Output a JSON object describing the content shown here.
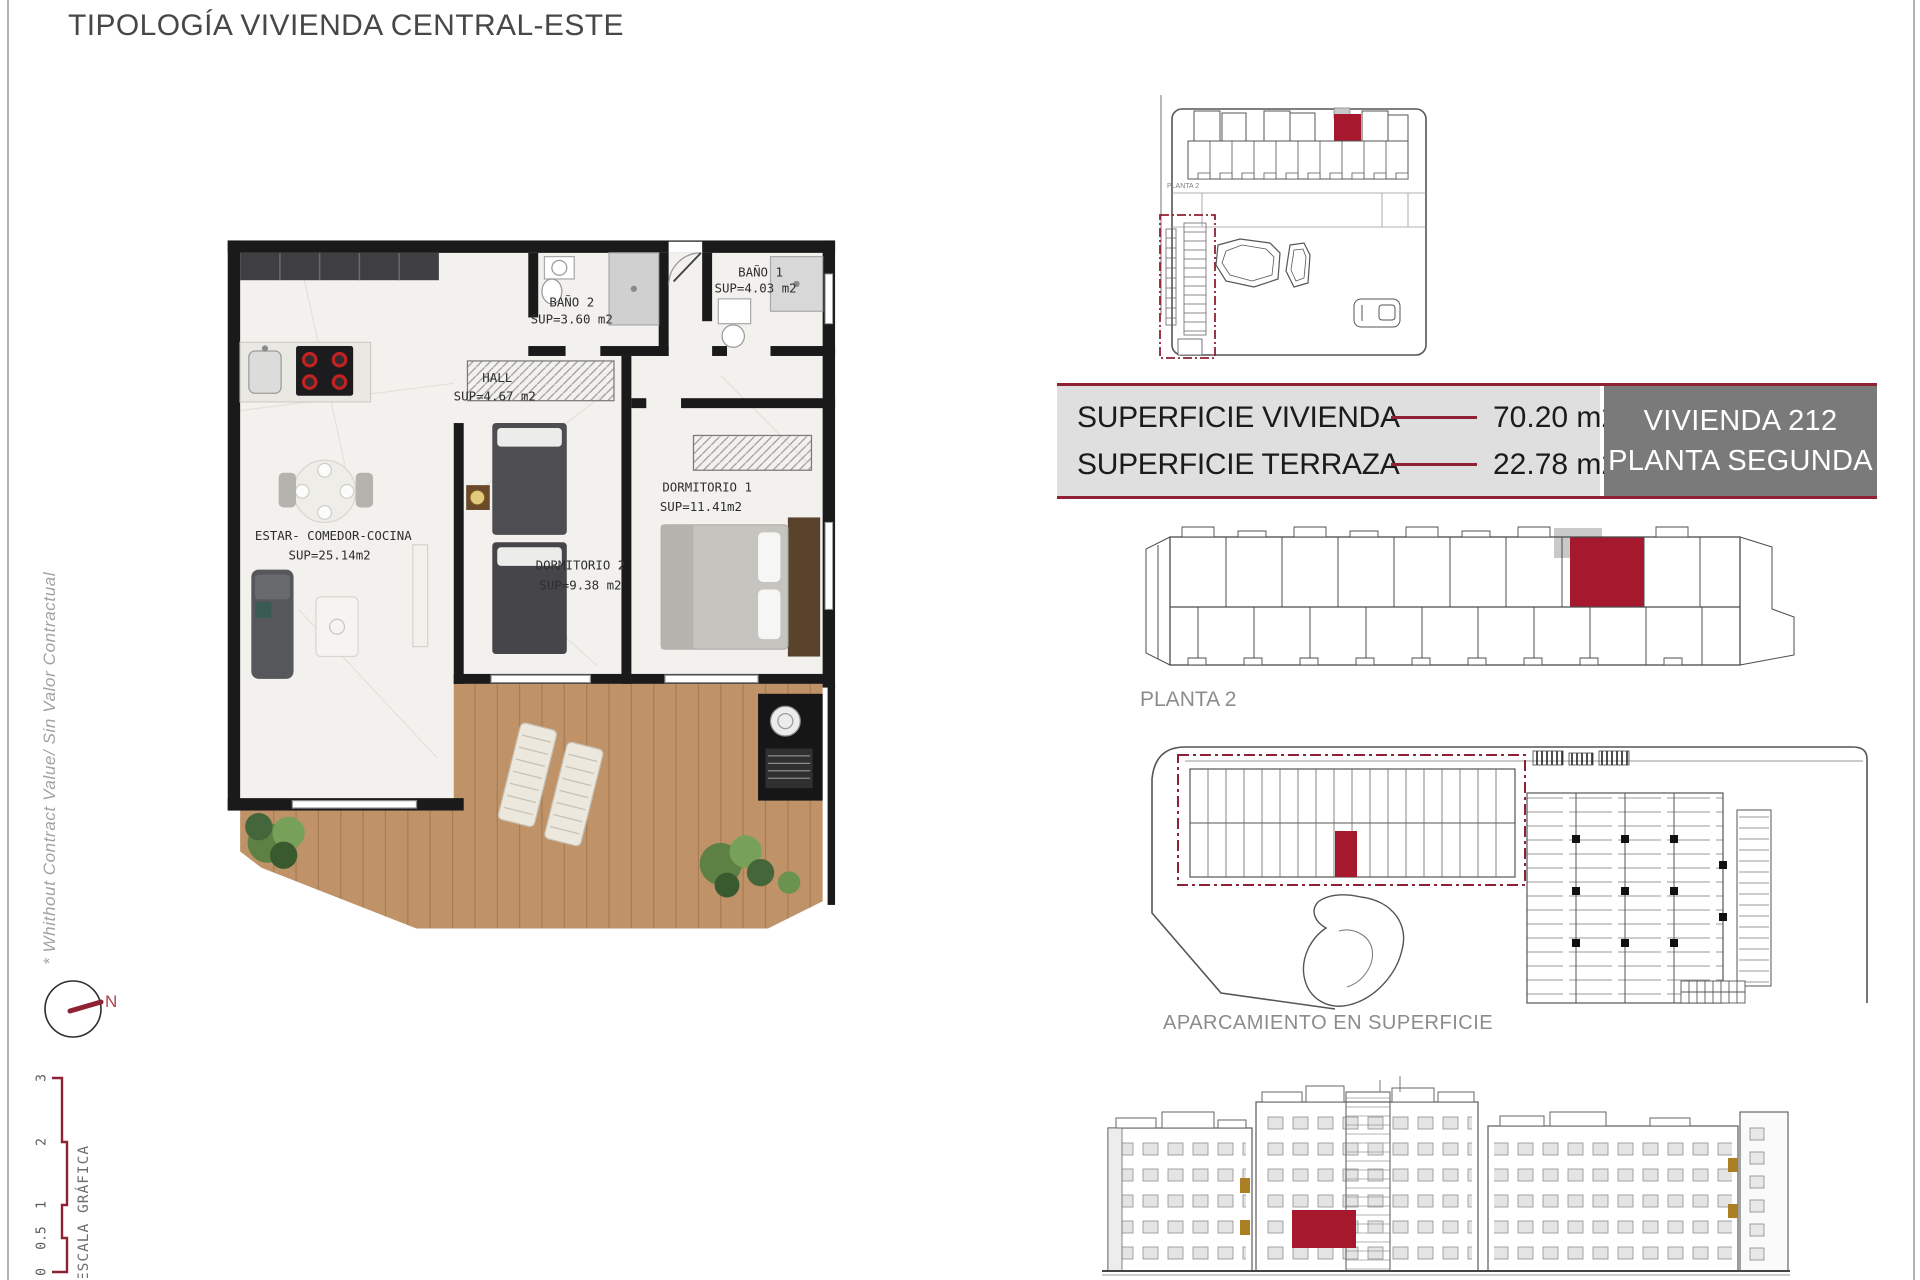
{
  "header": {
    "title": "TIPOLOGÍA VIVIENDA CENTRAL-ESTE"
  },
  "side_notes": {
    "disclaimer": "* Whithout Contract Value/ Sin Valor Contractual",
    "compass_label": "N",
    "scale_label": "ESCALA GRÁFICA",
    "scale_ticks": [
      "3",
      "2",
      "1",
      "0.5",
      "0"
    ]
  },
  "floorplan": {
    "rooms": [
      {
        "name": "BAÑO 1",
        "area": "SUP=4.03 m2"
      },
      {
        "name": "BAÑO 2",
        "area": "SUP=3.60 m2"
      },
      {
        "name": "HALL",
        "area": "SUP=4.67 m2"
      },
      {
        "name": "DORMITORIO 1",
        "area": "SUP=11.41m2"
      },
      {
        "name": "DORMITORIO 2",
        "area": "SUP=9.38 m2"
      },
      {
        "name": "ESTAR- COMEDOR-COCINA",
        "area": "SUP=25.14m2"
      }
    ]
  },
  "summary_table": {
    "rows": [
      {
        "label": "SUPERFICIE VIVIENDA",
        "value": "70.20 m2"
      },
      {
        "label": "SUPERFICIE TERRAZA",
        "value": "22.78 m2"
      }
    ],
    "unit_box": {
      "line1": "VIVIENDA 212",
      "line2": "PLANTA SEGUNDA"
    }
  },
  "drawings": {
    "keyplan": {
      "tiny_label": "PLANTA 2"
    },
    "floor_strip": {
      "caption": "PLANTA 2"
    },
    "parking": {
      "caption": "APARCAMIENTO EN SUPERFICIE"
    }
  },
  "colors": {
    "maroon_line": "#8E2133",
    "highlight_red": "#A5182E",
    "table_bg": "#DFDFDF",
    "unit_box_bg": "#7A7A7A",
    "terrace_wood": "#BF9268"
  }
}
